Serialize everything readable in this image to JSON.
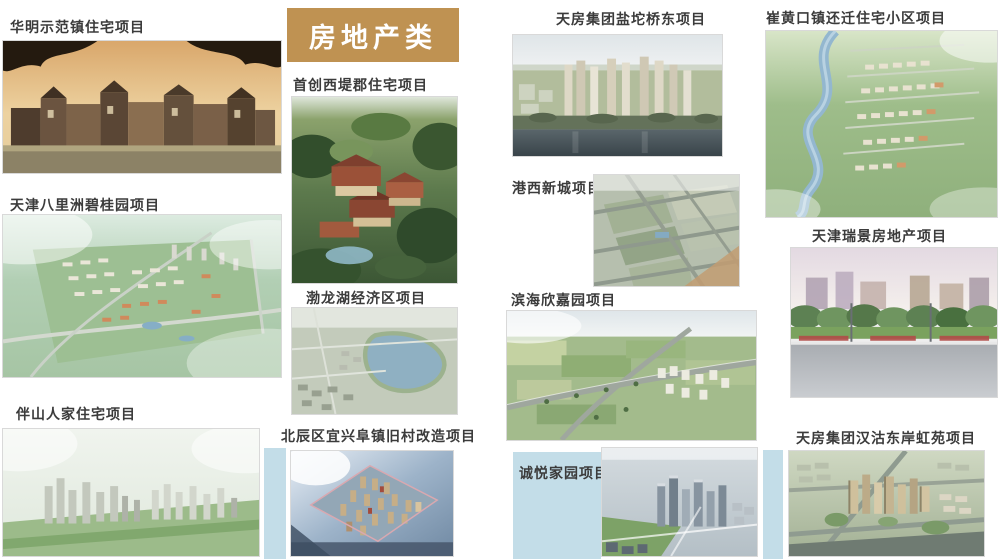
{
  "category_badge": {
    "label": "房地产类"
  },
  "colors": {
    "badge_gold": "#bf9252",
    "badge_text": "#ffffff",
    "label_text": "#3b3b3b",
    "strip_blue": "#c3dde8",
    "page_bg": "#ffffff"
  },
  "projects": {
    "huaming": {
      "label": "华明示范镇住宅项目"
    },
    "balizhou": {
      "label": "天津八里洲碧桂园项目"
    },
    "banshan": {
      "label": "伴山人家住宅项目"
    },
    "xidijun": {
      "label": "首创西堤郡住宅项目"
    },
    "bolonghu": {
      "label": "渤龙湖经济区项目"
    },
    "beichen": {
      "label": "北辰区宜兴阜镇旧村改造项目"
    },
    "yantuo": {
      "label": "天房集团盐坨桥东项目"
    },
    "gangxi": {
      "label": "港西新城项目"
    },
    "binhai": {
      "label": "滨海欣嘉园项目"
    },
    "chengyue": {
      "label": "诚悦家园项目"
    },
    "cuihuangkou": {
      "label": "崔黄口镇还迁住宅小区项目"
    },
    "ruijing": {
      "label": "天津瑞景房地产项目"
    },
    "hangu": {
      "label": "天房集团汉沽东岸虹苑项目"
    }
  }
}
